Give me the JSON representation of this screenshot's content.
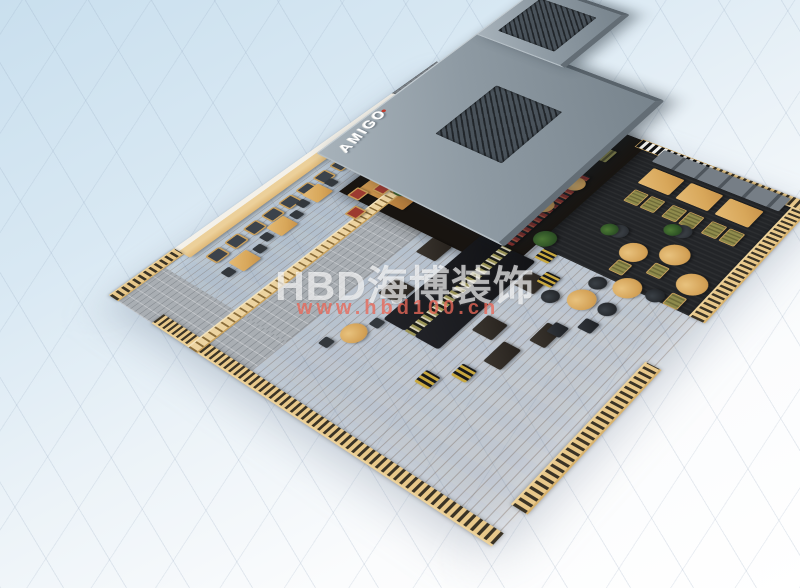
{
  "watermark": {
    "logo": "HBD海博装饰",
    "url": "www.hbd100.cn",
    "logo_color": "rgba(255,255,255,0.66)",
    "url_color": "rgba(233,104,88,0.78)"
  },
  "rooftop_sign": {
    "text": "AMIGO",
    "color": "#ffffff",
    "accent_dot_color": "#c0392b"
  },
  "scene": {
    "description": "isometric-3d-render-of-cafe-restaurant-floorplan",
    "bar_stool_count": 13,
    "colors": {
      "background_sky": "#d3e4f1",
      "mall_tile": "#fbfcfd",
      "roof": "#8e9aa3",
      "roof_fascia": "#59636b",
      "wood_floor": "#b27430",
      "bar_wood": "#ecd09a",
      "carpet": "#232528",
      "path_brick": "#a9aeb3",
      "railing_wood": "#e8c88a",
      "sofa_black": "#17181a",
      "olive_seat": "#8f8b4c",
      "red_cushion": "#9c3a30",
      "plant_green": "#2f5426",
      "ottoman_stripe_yellow": "#c8a83e"
    }
  }
}
